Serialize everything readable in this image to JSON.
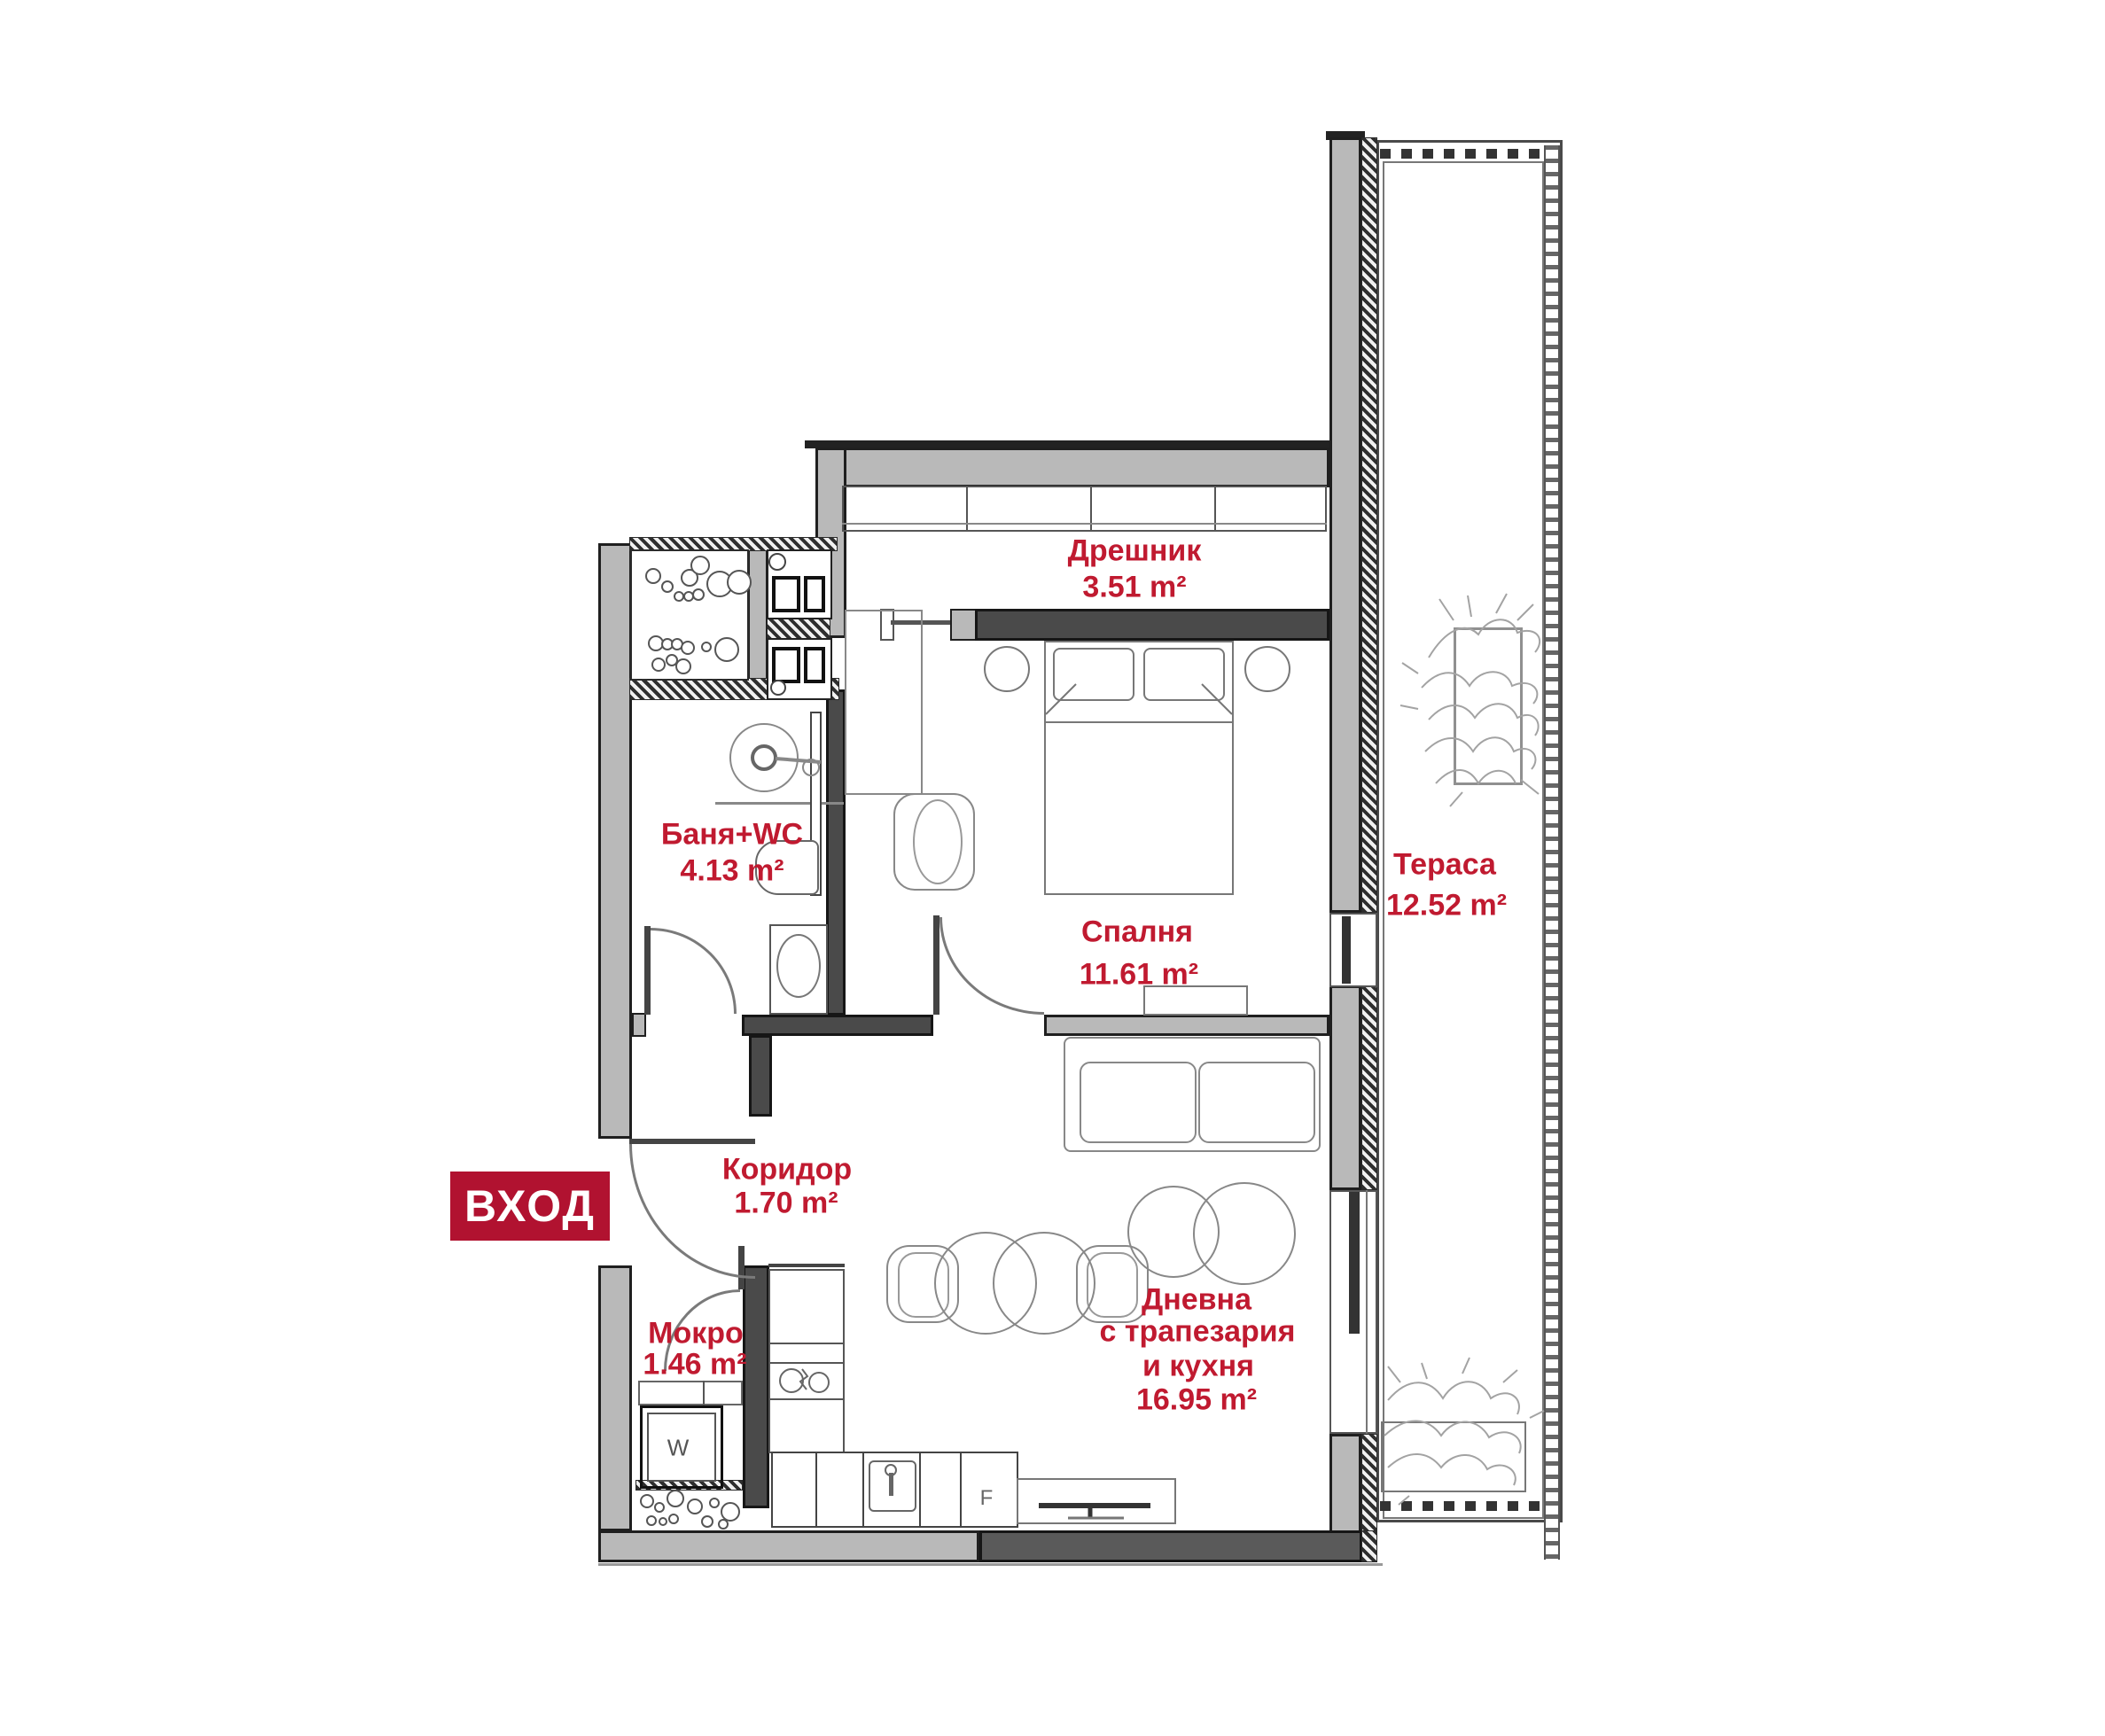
{
  "badge": {
    "label": "ВХОД"
  },
  "rooms": {
    "dreshnik": {
      "name": "Дрешник",
      "area": "3.51 m²"
    },
    "banya": {
      "name": "Баня+WC",
      "area": "4.13 m²"
    },
    "spalnya": {
      "name": "Спалня",
      "area": "11.61 m²"
    },
    "terasa": {
      "name": "Тераса",
      "area": "12.52 m²"
    },
    "koridor": {
      "name": "Коридор",
      "area": "1.70 m²"
    },
    "mokro": {
      "name": "Мокро",
      "area": "1.46 m²"
    },
    "dnevna": {
      "line1": "Дневна",
      "line2": "с трапезария",
      "line3": "и кухня",
      "area": "16.95 m²"
    }
  },
  "appliances": {
    "washer": "W",
    "fridge": "F"
  },
  "colors": {
    "label_red": "#c01a30",
    "badge_red": "#b11230",
    "wall_gray": "#b9b9b9",
    "wall_dark": "#4a4a4a"
  }
}
